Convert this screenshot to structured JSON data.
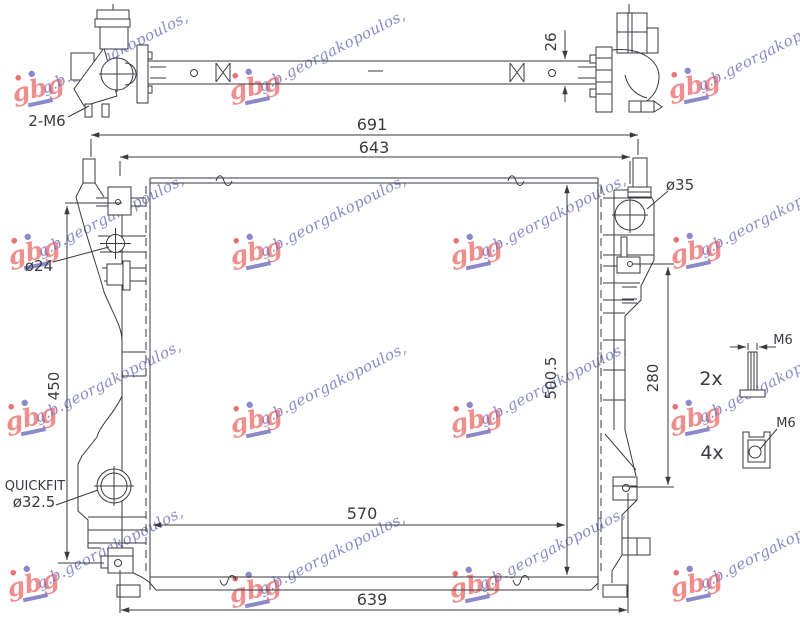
{
  "watermark": {
    "text": "g.b.georgakopoulos,",
    "logo": "gbg"
  },
  "top_view": {
    "bolt_note": "2-M6",
    "thickness": "26"
  },
  "dimensions": {
    "overall_width": "691",
    "upper_width": "643",
    "left_height": "450",
    "core_height": "500.5",
    "bracket_span": "280",
    "core_width": "570",
    "lower_width": "639"
  },
  "ports": {
    "inlet_diameter": "ø24",
    "outlet_diameter": "ø35",
    "quickfit_label": "QUICKFIT",
    "quickfit_size": "ø32.5"
  },
  "hardware": {
    "bolt_qty": "2x",
    "bolt_size": "M6",
    "clip_qty": "4x",
    "clip_size": "M6"
  },
  "colors": {
    "line": "#3a3a40",
    "watermark_text": "#7676c0",
    "watermark_logo": "#ee8282"
  }
}
